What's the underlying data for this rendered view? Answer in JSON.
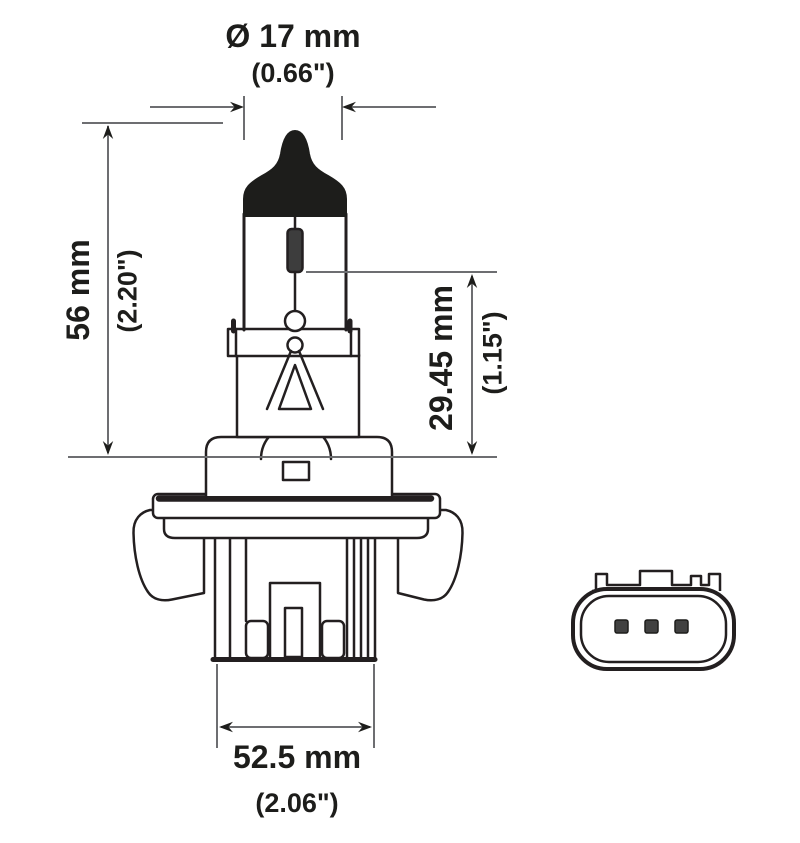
{
  "drawing": {
    "type": "technical-dimension-diagram",
    "subject": "halogen headlight bulb, front view with connector face view",
    "colors": {
      "outline": "#231f20",
      "dimension_line": "#6d6e71",
      "text": "#1d1d1b",
      "fill_dark": "#1d1d1b",
      "pin_fill": "#414141",
      "background": "#ffffff"
    },
    "dimensions": {
      "diameter": {
        "metric": "Ø 17 mm",
        "imperial": "(0.66\")"
      },
      "height": {
        "metric": "56 mm",
        "imperial": "(2.20\")"
      },
      "light_center": {
        "metric": "29.45 mm",
        "imperial": "(1.15\")"
      },
      "base_width": {
        "metric": "52.5 mm",
        "imperial": "(2.06\")"
      }
    }
  }
}
